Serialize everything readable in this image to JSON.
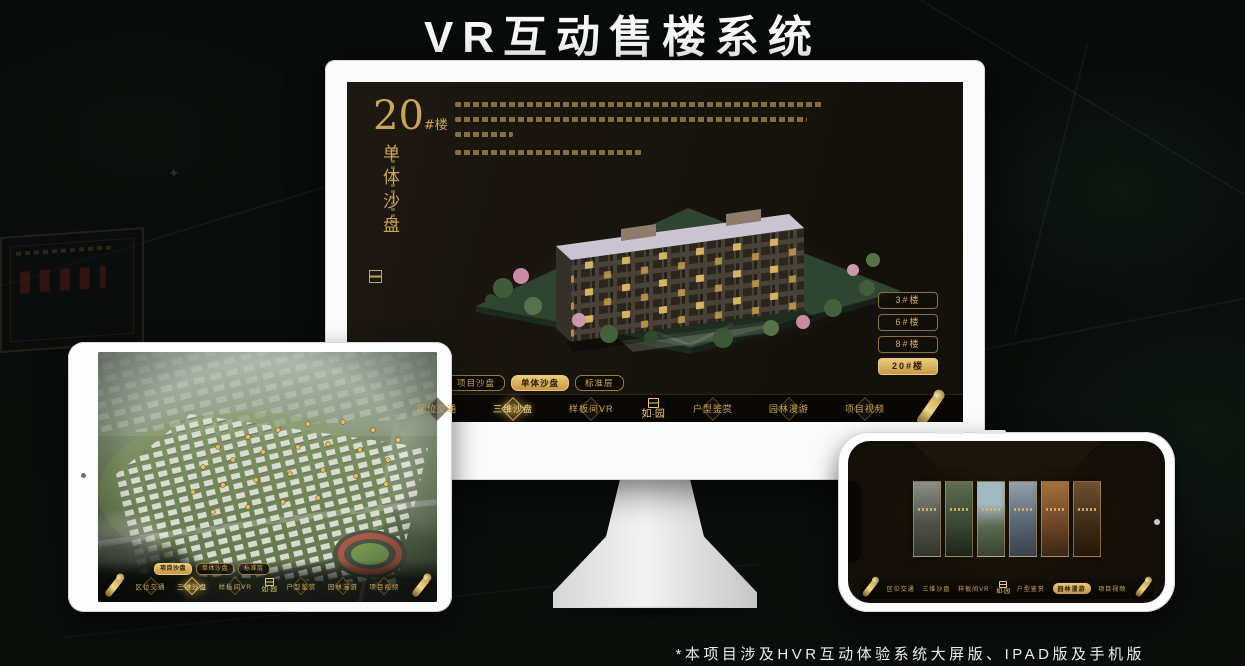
{
  "page": {
    "title": "VR互动售楼系统",
    "footnote": "*本项目涉及HVR互动体验系统大屏版、IPAD版及手机版"
  },
  "colors": {
    "gold": "#c9a55a",
    "gold_active": "#ecca7c",
    "screen_bg": "#191510",
    "page_bg": "#070b09",
    "device_white": "#fdfdfd"
  },
  "desktop": {
    "heading": {
      "number": "20",
      "suffix": "#楼",
      "subtitle": "单体沙盘"
    },
    "floor_buttons": [
      {
        "label": "3#楼",
        "active": false
      },
      {
        "label": "6#楼",
        "active": false
      },
      {
        "label": "8#楼",
        "active": false
      },
      {
        "label": "20#楼",
        "active": true
      }
    ],
    "tabs": [
      {
        "label": "项目沙盘",
        "active": false
      },
      {
        "label": "单体沙盘",
        "active": true
      },
      {
        "label": "标准层",
        "active": false
      }
    ],
    "nav": {
      "logo": "如·园",
      "items_left": [
        {
          "label": "区位交通",
          "active": false
        },
        {
          "label": "三维沙盘",
          "active": true
        },
        {
          "label": "样板间VR",
          "active": false
        }
      ],
      "items_right": [
        {
          "label": "户型鉴赏",
          "active": false
        },
        {
          "label": "园林漫游",
          "active": false
        },
        {
          "label": "项目视频",
          "active": false
        }
      ]
    }
  },
  "tablet": {
    "tabs": [
      {
        "label": "项目沙盘",
        "active": true
      },
      {
        "label": "单体沙盘",
        "active": false
      },
      {
        "label": "标准层",
        "active": false
      }
    ],
    "nav": {
      "logo": "如·园",
      "items_left": [
        {
          "label": "区位交通",
          "active": false
        },
        {
          "label": "三维沙盘",
          "active": true
        },
        {
          "label": "样板间VR",
          "active": false
        }
      ],
      "items_right": [
        {
          "label": "户型鉴赏",
          "active": false
        },
        {
          "label": "园林漫游",
          "active": false
        },
        {
          "label": "项目视频",
          "active": false
        }
      ]
    }
  },
  "phone": {
    "nav": {
      "logo": "如·园",
      "items_left": [
        {
          "label": "区位交通",
          "active": false
        },
        {
          "label": "三维沙盘",
          "active": false
        },
        {
          "label": "样板间VR",
          "active": false
        }
      ],
      "items_right": [
        {
          "label": "户型鉴赏",
          "active": false
        },
        {
          "label": "园林漫游",
          "active": true
        },
        {
          "label": "项目视频",
          "active": false
        }
      ]
    }
  }
}
